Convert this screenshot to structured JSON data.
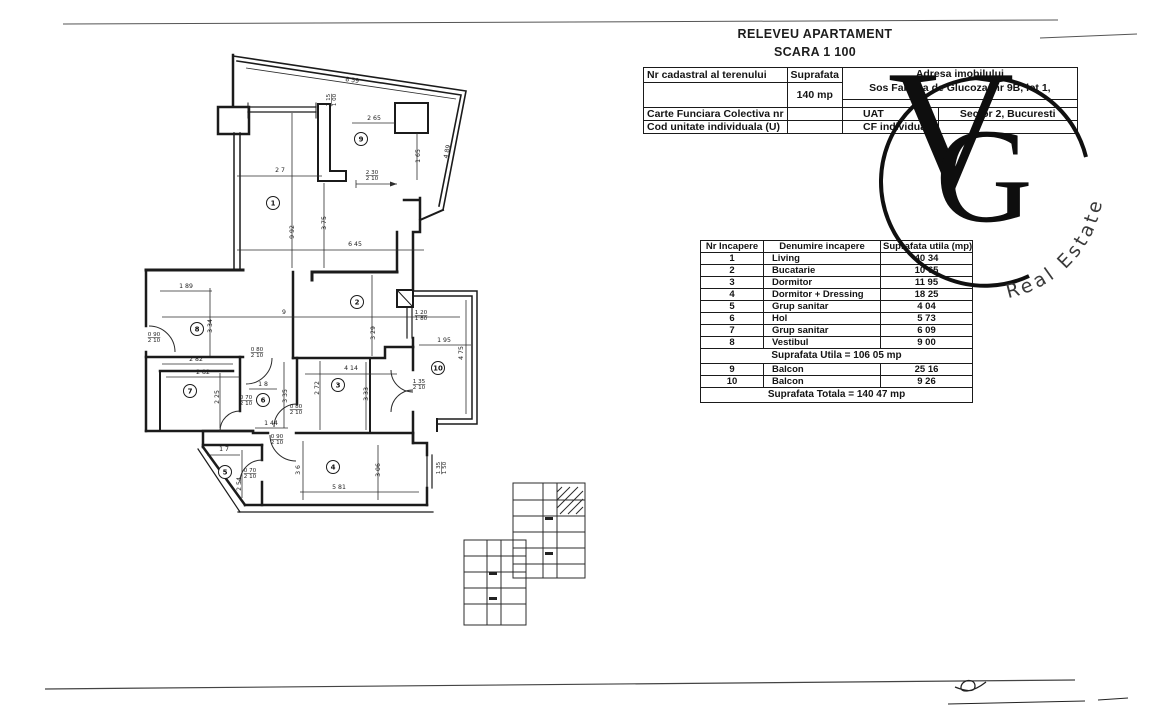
{
  "document": {
    "title": "RELEVEU APARTAMENT",
    "scale": "SCARA 1 100"
  },
  "header_table": {
    "r1c1": "Nr  cadastral al terenului",
    "r1c2": "Suprafata",
    "r1c3": "Adresa imobilului",
    "r2c2": "140 mp",
    "r2c3": "Sos  Fabrica de Glucoza, nr  9B, lot 1,",
    "r3c1": "Carte Funciara Colectiva nr",
    "r3c3": "UAT",
    "r3c4": "Sector 2, Bucuresti",
    "r4c1": "Cod unitate individuala (U)",
    "r4c3": "CF individuala",
    "r4c4": ""
  },
  "room_table": {
    "headers": [
      "Nr  Incapere",
      "Denumire incapere",
      "Suprafata utila (mp)"
    ],
    "rows": [
      [
        "1",
        "Living",
        "40 34"
      ],
      [
        "2",
        "Bucatarie",
        "10 65"
      ],
      [
        "3",
        "Dormitor",
        "11 95"
      ],
      [
        "4",
        "Dormitor + Dressing",
        "18 25"
      ],
      [
        "5",
        "Grup sanitar",
        "4 04"
      ],
      [
        "6",
        "Hol",
        "5 73"
      ],
      [
        "7",
        "Grup sanitar",
        "6 09"
      ],
      [
        "8",
        "Vestibul",
        "9 00"
      ]
    ],
    "subtotal": "Suprafata Utila =  106 05 mp",
    "balcony_rows": [
      [
        "9",
        "Balcon",
        "25 16"
      ],
      [
        "10",
        "Balcon",
        "9 26"
      ]
    ],
    "total": "Suprafata Totala =  140 47 mp"
  },
  "logo": {
    "letter_v": "V",
    "letter_g": "G",
    "arc_text": "Real Estate",
    "color": "#111111"
  },
  "floorplan": {
    "rooms": [
      {
        "n": "1",
        "x": 273,
        "y": 203
      },
      {
        "n": "2",
        "x": 357,
        "y": 302
      },
      {
        "n": "3",
        "x": 338,
        "y": 385
      },
      {
        "n": "4",
        "x": 333,
        "y": 467
      },
      {
        "n": "5",
        "x": 225,
        "y": 472
      },
      {
        "n": "6",
        "x": 263,
        "y": 400
      },
      {
        "n": "7",
        "x": 190,
        "y": 391
      },
      {
        "n": "8",
        "x": 197,
        "y": 329
      },
      {
        "n": "9",
        "x": 361,
        "y": 139
      },
      {
        "n": "10",
        "x": 438,
        "y": 368
      }
    ],
    "labels": [
      {
        "t": "8 59",
        "x": 352,
        "y": 82,
        "r": 8
      },
      {
        "t": "2 15|1 00",
        "x": 330,
        "y": 100,
        "r": -90
      },
      {
        "t": "2 65",
        "x": 374,
        "y": 120,
        "r": 0
      },
      {
        "t": "1 65",
        "x": 420,
        "y": 156,
        "r": -90
      },
      {
        "t": "4 89",
        "x": 449,
        "y": 152,
        "r": -78
      },
      {
        "t": "2 7",
        "x": 280,
        "y": 172,
        "r": 0
      },
      {
        "t": "2 30|2 10",
        "x": 372,
        "y": 174,
        "r": 0
      },
      {
        "t": "9 92",
        "x": 294,
        "y": 232,
        "r": -90
      },
      {
        "t": "3 75",
        "x": 326,
        "y": 223,
        "r": -90
      },
      {
        "t": "6 45",
        "x": 355,
        "y": 246,
        "r": 0
      },
      {
        "t": "1 89",
        "x": 186,
        "y": 288,
        "r": 0
      },
      {
        "t": "3 34",
        "x": 212,
        "y": 326,
        "r": -90
      },
      {
        "t": "9",
        "x": 284,
        "y": 314,
        "r": 0
      },
      {
        "t": "3 29",
        "x": 375,
        "y": 333,
        "r": -90
      },
      {
        "t": "1 20|1 80",
        "x": 421,
        "y": 314,
        "r": 0
      },
      {
        "t": "0 90|2 10",
        "x": 154,
        "y": 336,
        "r": 0
      },
      {
        "t": "1 95",
        "x": 444,
        "y": 342,
        "r": 0
      },
      {
        "t": "4 75",
        "x": 463,
        "y": 353,
        "r": -90
      },
      {
        "t": "2 82",
        "x": 196,
        "y": 361,
        "r": 0
      },
      {
        "t": "2 82",
        "x": 203,
        "y": 374,
        "r": 0
      },
      {
        "t": "0 80|2 10",
        "x": 257,
        "y": 351,
        "r": 0
      },
      {
        "t": "4 14",
        "x": 351,
        "y": 370,
        "r": 0
      },
      {
        "t": "1 8",
        "x": 263,
        "y": 386,
        "r": 0
      },
      {
        "t": "2 72",
        "x": 319,
        "y": 388,
        "r": -90
      },
      {
        "t": "2 25",
        "x": 219,
        "y": 397,
        "r": -90
      },
      {
        "t": "3 35",
        "x": 287,
        "y": 396,
        "r": -90
      },
      {
        "t": "3 33",
        "x": 368,
        "y": 394,
        "r": -90
      },
      {
        "t": "0 70|2 10",
        "x": 246,
        "y": 399,
        "r": 0
      },
      {
        "t": "0 80|2 10",
        "x": 296,
        "y": 408,
        "r": 0
      },
      {
        "t": "1 35|2 10",
        "x": 419,
        "y": 383,
        "r": 0
      },
      {
        "t": "1 44",
        "x": 271,
        "y": 425,
        "r": 0
      },
      {
        "t": "0 90|2 10",
        "x": 277,
        "y": 438,
        "r": 0
      },
      {
        "t": "1 7",
        "x": 224,
        "y": 451,
        "r": 0
      },
      {
        "t": "2 54",
        "x": 241,
        "y": 484,
        "r": -90
      },
      {
        "t": "0 70|2 10",
        "x": 250,
        "y": 472,
        "r": 0
      },
      {
        "t": "3 6",
        "x": 300,
        "y": 470,
        "r": -90
      },
      {
        "t": "5 81",
        "x": 339,
        "y": 489,
        "r": 0
      },
      {
        "t": "3 06",
        "x": 380,
        "y": 470,
        "r": -90
      },
      {
        "t": "1 35|1 50",
        "x": 440,
        "y": 468,
        "r": -90
      }
    ]
  }
}
